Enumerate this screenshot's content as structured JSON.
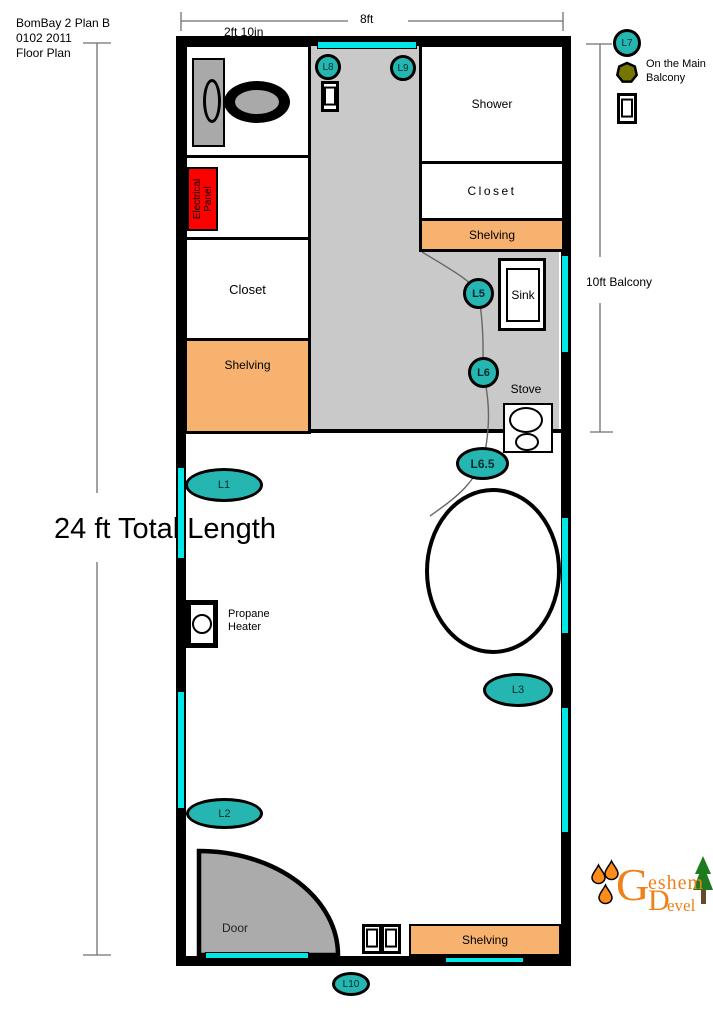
{
  "title_block": {
    "line1": "BomBay 2 Plan B",
    "line2": "0102 2011",
    "line3": "Floor Plan"
  },
  "dimensions": {
    "width_total": "8ft",
    "width_section": "2ft 10in",
    "length_total": "24 ft Total Length",
    "balcony": "10ft Balcony"
  },
  "rooms": {
    "shower": "Shower",
    "closet_right": "Closet",
    "shelving_right": "Shelving",
    "closet_left": "Closet",
    "shelving_left": "Shelving",
    "shelving_bottom": "Shelving",
    "door": "Door",
    "sink": "Sink",
    "stove": "Stove",
    "electrical_panel": "Electrical Panel",
    "propane_heater": "Propane Heater"
  },
  "lights": {
    "l1": "L1",
    "l2": "L2",
    "l3": "L3",
    "l5": "L5",
    "l6": "L6",
    "l6_5": "L6.5",
    "l7": "L7",
    "l8": "L8",
    "l9": "L9",
    "l10": "L10"
  },
  "notes": {
    "balcony_light": "On the Main Balcony"
  },
  "logo": {
    "initial_top": "G",
    "rest_top": "eshem",
    "initial_bottom": "D",
    "rest_bottom": "evel"
  },
  "colors": {
    "window": "#00E5E5",
    "light": "#26B6B2",
    "shelving": "#F6B26E",
    "corridor": "#C9C9C9",
    "electrical_panel": "#FF0000",
    "door": "#ABABAB",
    "logo_orange": "#F08018",
    "balcony_fixture": "#757500"
  }
}
